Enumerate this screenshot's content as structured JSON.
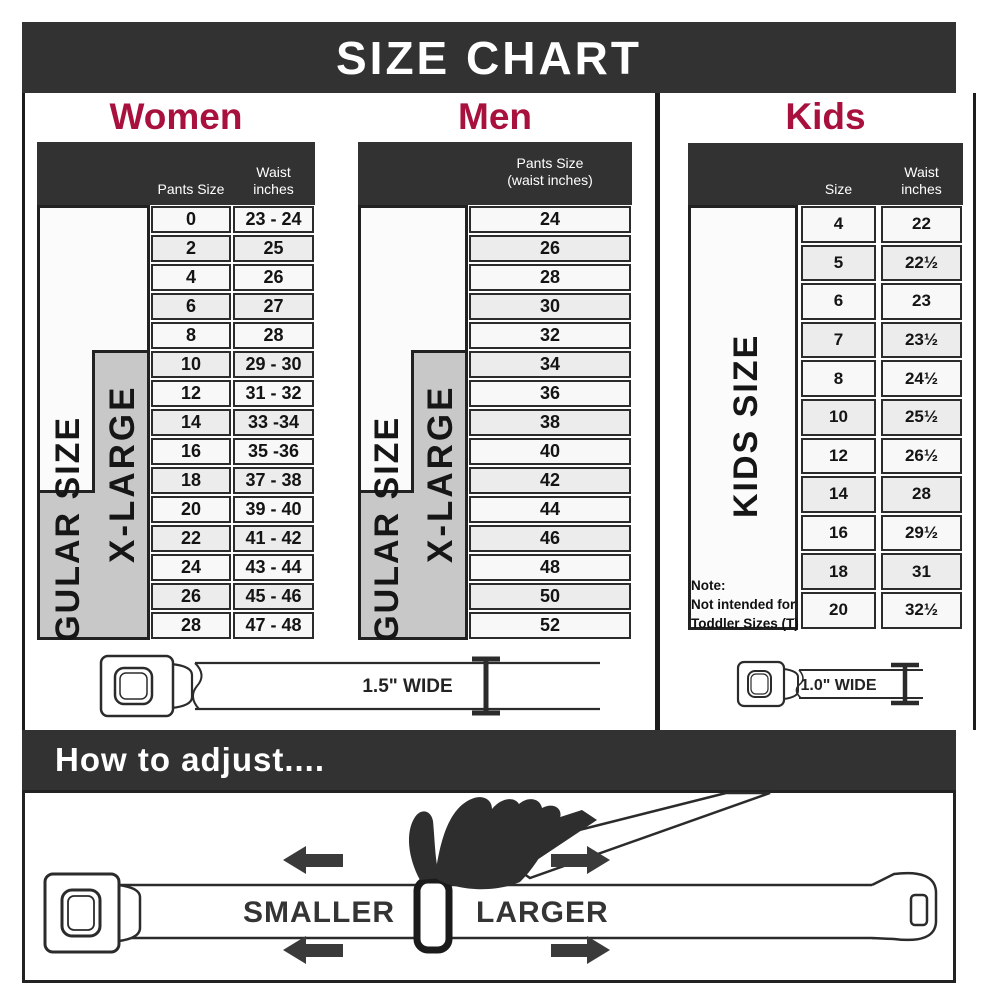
{
  "header": {
    "title": "SIZE CHART"
  },
  "colors": {
    "bar": "#323232",
    "accent": "#A8113D",
    "row_light": "#F8F8F8",
    "row_dark": "#ECECEC",
    "xlarge_fill": "#C8C8C8",
    "line": "#2B2B2B"
  },
  "women": {
    "title": "Women",
    "col_size": "Pants Size",
    "col_waist_line1": "Waist",
    "col_waist_line2": "inches",
    "regular_label": "REGULAR SIZE",
    "xlarge_label": "X-LARGE",
    "rows": [
      [
        "0",
        "23 - 24"
      ],
      [
        "2",
        "25"
      ],
      [
        "4",
        "26"
      ],
      [
        "6",
        "27"
      ],
      [
        "8",
        "28"
      ],
      [
        "10",
        "29 - 30"
      ],
      [
        "12",
        "31 - 32"
      ],
      [
        "14",
        "33 -34"
      ],
      [
        "16",
        "35 -36"
      ],
      [
        "18",
        "37 - 38"
      ],
      [
        "20",
        "39 - 40"
      ],
      [
        "22",
        "41 - 42"
      ],
      [
        "24",
        "43 - 44"
      ],
      [
        "26",
        "45 - 46"
      ],
      [
        "28",
        "47 - 48"
      ]
    ]
  },
  "men": {
    "title": "Men",
    "col_line1": "Pants Size",
    "col_line2": "(waist inches)",
    "regular_label": "REGULAR SIZE",
    "xlarge_label": "X-LARGE",
    "rows": [
      "24",
      "26",
      "28",
      "30",
      "32",
      "34",
      "36",
      "38",
      "40",
      "42",
      "44",
      "46",
      "48",
      "50",
      "52"
    ]
  },
  "kids": {
    "title": "Kids",
    "col_size": "Size",
    "col_waist_line1": "Waist",
    "col_waist_line2": "inches",
    "side_label": "KIDS SIZE",
    "note": [
      "Note:",
      "Not intended for",
      "Toddler Sizes (T)"
    ],
    "rows": [
      [
        "4",
        "22"
      ],
      [
        "5",
        "22½"
      ],
      [
        "6",
        "23"
      ],
      [
        "7",
        "23½"
      ],
      [
        "8",
        "24½"
      ],
      [
        "10",
        "25½"
      ],
      [
        "12",
        "26½"
      ],
      [
        "14",
        "28"
      ],
      [
        "16",
        "29½"
      ],
      [
        "18",
        "31"
      ],
      [
        "20",
        "32½"
      ]
    ]
  },
  "belts": {
    "adult_width_label": "1.5\" WIDE",
    "kids_width_label": "1.0\" WIDE"
  },
  "adjust": {
    "heading": "How to adjust....",
    "smaller": "SMALLER",
    "larger": "LARGER"
  }
}
